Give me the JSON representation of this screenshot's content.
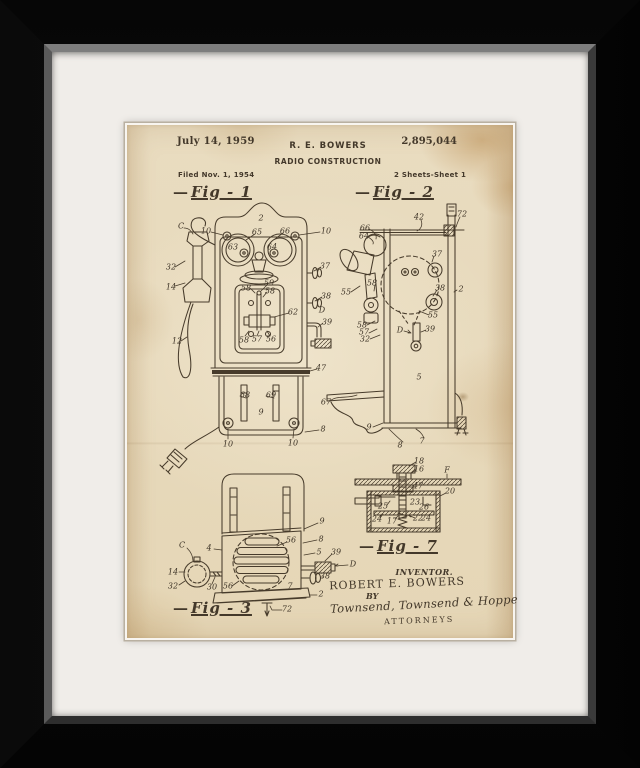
{
  "artwork": {
    "frame_color": "#0a0a0a",
    "mat_color": "#f0ede9",
    "paper_color": "#e8dcc0",
    "ink_color": "#43382a"
  },
  "patent": {
    "date": "July 14, 1959",
    "inventor_header": "R. E. BOWERS",
    "patent_number": "2,895,044",
    "title": "RADIO CONSTRUCTION",
    "filed": "Filed Nov. 1, 1954",
    "sheet": "2 Sheets-Sheet 1",
    "figures": {
      "fig1": {
        "label": "Fig - 1"
      },
      "fig2": {
        "label": "Fig - 2"
      },
      "fig3": {
        "label": "Fig - 3"
      },
      "fig7": {
        "label": "Fig - 7"
      }
    },
    "signature_block": {
      "inventor_caption": "INVENTOR.",
      "inventor_name": "ROBERT E. BOWERS",
      "by": "BY",
      "signature": "Townsend, Townsend & Hoppe",
      "attorneys": "ATTORNEYS"
    },
    "annotations": [
      {
        "fig": "1",
        "t": "C",
        "x": 54,
        "y": 101
      },
      {
        "fig": "1",
        "t": "2",
        "x": 134,
        "y": 93
      },
      {
        "fig": "1",
        "t": "10",
        "x": 79,
        "y": 106
      },
      {
        "fig": "1",
        "t": "10",
        "x": 199,
        "y": 106
      },
      {
        "fig": "1",
        "t": "65",
        "x": 130,
        "y": 107
      },
      {
        "fig": "1",
        "t": "66",
        "x": 158,
        "y": 106
      },
      {
        "fig": "1",
        "t": "63",
        "x": 106,
        "y": 122
      },
      {
        "fig": "1",
        "t": "64",
        "x": 145,
        "y": 122
      },
      {
        "fig": "1",
        "t": "32",
        "x": 44,
        "y": 142
      },
      {
        "fig": "1",
        "t": "14",
        "x": 44,
        "y": 162
      },
      {
        "fig": "1",
        "t": "58",
        "x": 119,
        "y": 163
      },
      {
        "fig": "1",
        "t": "59",
        "x": 142,
        "y": 158
      },
      {
        "fig": "1",
        "t": "58",
        "x": 143,
        "y": 166
      },
      {
        "fig": "1",
        "t": "37",
        "x": 198,
        "y": 141
      },
      {
        "fig": "1",
        "t": "38",
        "x": 199,
        "y": 171
      },
      {
        "fig": "1",
        "t": "D",
        "x": 195,
        "y": 185
      },
      {
        "fig": "1",
        "t": "39",
        "x": 200,
        "y": 197
      },
      {
        "fig": "1",
        "t": "62",
        "x": 166,
        "y": 187
      },
      {
        "fig": "1",
        "t": "12",
        "x": 50,
        "y": 216
      },
      {
        "fig": "1",
        "t": "58",
        "x": 117,
        "y": 215
      },
      {
        "fig": "1",
        "t": "57",
        "x": 130,
        "y": 214
      },
      {
        "fig": "1",
        "t": "56",
        "x": 144,
        "y": 214
      },
      {
        "fig": "1",
        "t": "47",
        "x": 194,
        "y": 243
      },
      {
        "fig": "1",
        "t": "67",
        "x": 199,
        "y": 277
      },
      {
        "fig": "1",
        "t": "68",
        "x": 118,
        "y": 270
      },
      {
        "fig": "1",
        "t": "69",
        "x": 144,
        "y": 270
      },
      {
        "fig": "1",
        "t": "9",
        "x": 134,
        "y": 287
      },
      {
        "fig": "1",
        "t": "8",
        "x": 196,
        "y": 304
      },
      {
        "fig": "1",
        "t": "10",
        "x": 101,
        "y": 319
      },
      {
        "fig": "1",
        "t": "10",
        "x": 166,
        "y": 318
      },
      {
        "fig": "2",
        "t": "42",
        "x": 292,
        "y": 92
      },
      {
        "fig": "2",
        "t": "72",
        "x": 335,
        "y": 89
      },
      {
        "fig": "2",
        "t": "66",
        "x": 238,
        "y": 103
      },
      {
        "fig": "2",
        "t": "64",
        "x": 237,
        "y": 111
      },
      {
        "fig": "2",
        "t": "37",
        "x": 310,
        "y": 129
      },
      {
        "fig": "2",
        "t": "2",
        "x": 334,
        "y": 164
      },
      {
        "fig": "2",
        "t": "38",
        "x": 313,
        "y": 163
      },
      {
        "fig": "2",
        "t": "55",
        "x": 219,
        "y": 167
      },
      {
        "fig": "2",
        "t": "58",
        "x": 245,
        "y": 158
      },
      {
        "fig": "2",
        "t": "58",
        "x": 235,
        "y": 200
      },
      {
        "fig": "2",
        "t": "57",
        "x": 237,
        "y": 207
      },
      {
        "fig": "2",
        "t": "32",
        "x": 238,
        "y": 214
      },
      {
        "fig": "2",
        "t": "55",
        "x": 306,
        "y": 190
      },
      {
        "fig": "2",
        "t": "39",
        "x": 303,
        "y": 204
      },
      {
        "fig": "2",
        "t": "D",
        "x": 273,
        "y": 205
      },
      {
        "fig": "2",
        "t": "5",
        "x": 292,
        "y": 252
      },
      {
        "fig": "2",
        "t": "9",
        "x": 242,
        "y": 302
      },
      {
        "fig": "2",
        "t": "8",
        "x": 273,
        "y": 320
      },
      {
        "fig": "2",
        "t": "7",
        "x": 295,
        "y": 316
      },
      {
        "fig": "3",
        "t": "C",
        "x": 55,
        "y": 420
      },
      {
        "fig": "3",
        "t": "4",
        "x": 82,
        "y": 423
      },
      {
        "fig": "3",
        "t": "9",
        "x": 195,
        "y": 396
      },
      {
        "fig": "3",
        "t": "8",
        "x": 194,
        "y": 414
      },
      {
        "fig": "3",
        "t": "56",
        "x": 164,
        "y": 415
      },
      {
        "fig": "3",
        "t": "5",
        "x": 192,
        "y": 427
      },
      {
        "fig": "3",
        "t": "39",
        "x": 209,
        "y": 427
      },
      {
        "fig": "3",
        "t": "D",
        "x": 226,
        "y": 439
      },
      {
        "fig": "3",
        "t": "14",
        "x": 46,
        "y": 447
      },
      {
        "fig": "3",
        "t": "38",
        "x": 198,
        "y": 451
      },
      {
        "fig": "3",
        "t": "32",
        "x": 46,
        "y": 461
      },
      {
        "fig": "3",
        "t": "30",
        "x": 85,
        "y": 462
      },
      {
        "fig": "3",
        "t": "56",
        "x": 101,
        "y": 461
      },
      {
        "fig": "3",
        "t": "7",
        "x": 163,
        "y": 461
      },
      {
        "fig": "3",
        "t": "2",
        "x": 194,
        "y": 469
      },
      {
        "fig": "3",
        "t": "72",
        "x": 160,
        "y": 484
      },
      {
        "fig": "7",
        "t": "18",
        "x": 292,
        "y": 336
      },
      {
        "fig": "7",
        "t": "16",
        "x": 292,
        "y": 344
      },
      {
        "fig": "7",
        "t": "F",
        "x": 320,
        "y": 345
      },
      {
        "fig": "7",
        "t": "47",
        "x": 291,
        "y": 361
      },
      {
        "fig": "7",
        "t": "20",
        "x": 323,
        "y": 366
      },
      {
        "fig": "7",
        "t": "25",
        "x": 256,
        "y": 381
      },
      {
        "fig": "7",
        "t": "23",
        "x": 288,
        "y": 377
      },
      {
        "fig": "7",
        "t": "26",
        "x": 297,
        "y": 382
      },
      {
        "fig": "7",
        "t": "24",
        "x": 250,
        "y": 394
      },
      {
        "fig": "7",
        "t": "17",
        "x": 265,
        "y": 396
      },
      {
        "fig": "7",
        "t": "22",
        "x": 291,
        "y": 393
      },
      {
        "fig": "7",
        "t": "24",
        "x": 299,
        "y": 393
      }
    ]
  }
}
